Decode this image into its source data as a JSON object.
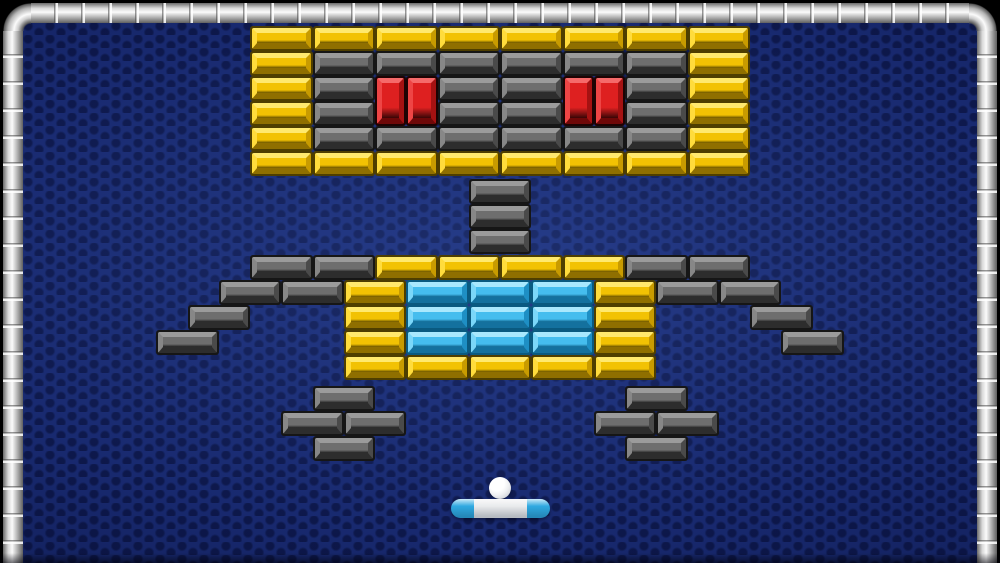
{
  "field": {
    "background_base": "#18296F",
    "texture_dot": "#040A2D",
    "frame_silver_bright": "#FBFBFB",
    "frame_silver_mid": "#C6C6C6",
    "frame_silver_edge": "#5E5E5E"
  },
  "colors": {
    "bricks": {
      "yellow": {
        "outline": "#4E3E00",
        "light": "#FFE96E",
        "light_mid": "#FFDC3C",
        "face": "#F2C203",
        "shadow_mid": "#C89B00",
        "shadow": "#8F6F00"
      },
      "gray": {
        "outline": "#161616",
        "light": "#9B9B9B",
        "light_mid": "#878787",
        "face": "#6E6E6E",
        "shadow_mid": "#4A4A4A",
        "shadow": "#2D2D2D"
      },
      "red": {
        "outline": "#1E0303",
        "light": "#F56A6A",
        "light_mid": "#EE4545",
        "face": "#DE2020",
        "shadow_mid": "#A51212",
        "shadow": "#6E0808"
      },
      "cyan": {
        "outline": "#0A5A80",
        "light": "#A9E8FD",
        "light_mid": "#7BD7F9",
        "face": "#45BDEE",
        "shadow_mid": "#1E8FC4",
        "shadow": "#14719E"
      }
    },
    "ball": "#FFFFFF",
    "paddle_end": "#2FA9E1",
    "paddle_center": "#E9EAEC"
  },
  "bricks": {
    "default_w": 62.5,
    "default_h": 25,
    "list": [
      {
        "x": 250,
        "y": 26,
        "c": "yellow"
      },
      {
        "x": 312.5,
        "y": 26,
        "c": "yellow"
      },
      {
        "x": 375,
        "y": 26,
        "c": "yellow"
      },
      {
        "x": 437.5,
        "y": 26,
        "c": "yellow"
      },
      {
        "x": 500,
        "y": 26,
        "c": "yellow"
      },
      {
        "x": 562.5,
        "y": 26,
        "c": "yellow"
      },
      {
        "x": 625,
        "y": 26,
        "c": "yellow"
      },
      {
        "x": 687.5,
        "y": 26,
        "c": "yellow"
      },
      {
        "x": 250,
        "y": 51,
        "c": "yellow"
      },
      {
        "x": 312.5,
        "y": 51,
        "c": "gray"
      },
      {
        "x": 375,
        "y": 51,
        "c": "gray"
      },
      {
        "x": 437.5,
        "y": 51,
        "c": "gray"
      },
      {
        "x": 500,
        "y": 51,
        "c": "gray"
      },
      {
        "x": 562.5,
        "y": 51,
        "c": "gray"
      },
      {
        "x": 625,
        "y": 51,
        "c": "gray"
      },
      {
        "x": 687.5,
        "y": 51,
        "c": "yellow"
      },
      {
        "x": 250,
        "y": 76,
        "c": "yellow"
      },
      {
        "x": 312.5,
        "y": 76,
        "c": "gray"
      },
      {
        "x": 437.5,
        "y": 76,
        "c": "gray"
      },
      {
        "x": 500,
        "y": 76,
        "c": "gray"
      },
      {
        "x": 625,
        "y": 76,
        "c": "gray"
      },
      {
        "x": 687.5,
        "y": 76,
        "c": "yellow"
      },
      {
        "x": 375,
        "y": 76,
        "w": 31.25,
        "h": 50,
        "c": "red"
      },
      {
        "x": 406.25,
        "y": 76,
        "w": 31.25,
        "h": 50,
        "c": "red"
      },
      {
        "x": 562.5,
        "y": 76,
        "w": 31.25,
        "h": 50,
        "c": "red"
      },
      {
        "x": 593.75,
        "y": 76,
        "w": 31.25,
        "h": 50,
        "c": "red"
      },
      {
        "x": 250,
        "y": 101,
        "c": "yellow"
      },
      {
        "x": 312.5,
        "y": 101,
        "c": "gray"
      },
      {
        "x": 437.5,
        "y": 101,
        "c": "gray"
      },
      {
        "x": 500,
        "y": 101,
        "c": "gray"
      },
      {
        "x": 625,
        "y": 101,
        "c": "gray"
      },
      {
        "x": 687.5,
        "y": 101,
        "c": "yellow"
      },
      {
        "x": 250,
        "y": 126,
        "c": "yellow"
      },
      {
        "x": 312.5,
        "y": 126,
        "c": "gray"
      },
      {
        "x": 375,
        "y": 126,
        "c": "gray"
      },
      {
        "x": 437.5,
        "y": 126,
        "c": "gray"
      },
      {
        "x": 500,
        "y": 126,
        "c": "gray"
      },
      {
        "x": 562.5,
        "y": 126,
        "c": "gray"
      },
      {
        "x": 625,
        "y": 126,
        "c": "gray"
      },
      {
        "x": 687.5,
        "y": 126,
        "c": "yellow"
      },
      {
        "x": 250,
        "y": 151,
        "c": "yellow"
      },
      {
        "x": 312.5,
        "y": 151,
        "c": "yellow"
      },
      {
        "x": 375,
        "y": 151,
        "c": "yellow"
      },
      {
        "x": 437.5,
        "y": 151,
        "c": "yellow"
      },
      {
        "x": 500,
        "y": 151,
        "c": "yellow"
      },
      {
        "x": 562.5,
        "y": 151,
        "c": "yellow"
      },
      {
        "x": 625,
        "y": 151,
        "c": "yellow"
      },
      {
        "x": 687.5,
        "y": 151,
        "c": "yellow"
      },
      {
        "x": 468.75,
        "y": 179,
        "c": "gray"
      },
      {
        "x": 468.75,
        "y": 204,
        "c": "gray"
      },
      {
        "x": 468.75,
        "y": 229,
        "c": "gray"
      },
      {
        "x": 250,
        "y": 255,
        "c": "gray"
      },
      {
        "x": 312.5,
        "y": 255,
        "c": "gray"
      },
      {
        "x": 375,
        "y": 255,
        "c": "yellow"
      },
      {
        "x": 437.5,
        "y": 255,
        "c": "yellow"
      },
      {
        "x": 500,
        "y": 255,
        "c": "yellow"
      },
      {
        "x": 562.5,
        "y": 255,
        "c": "yellow"
      },
      {
        "x": 625,
        "y": 255,
        "c": "gray"
      },
      {
        "x": 687.5,
        "y": 255,
        "c": "gray"
      },
      {
        "x": 218.75,
        "y": 280,
        "c": "gray"
      },
      {
        "x": 281.25,
        "y": 280,
        "c": "gray"
      },
      {
        "x": 343.75,
        "y": 280,
        "c": "yellow"
      },
      {
        "x": 406.25,
        "y": 280,
        "c": "cyan"
      },
      {
        "x": 468.75,
        "y": 280,
        "c": "cyan"
      },
      {
        "x": 531.25,
        "y": 280,
        "c": "cyan"
      },
      {
        "x": 593.75,
        "y": 280,
        "c": "yellow"
      },
      {
        "x": 656.25,
        "y": 280,
        "c": "gray"
      },
      {
        "x": 718.75,
        "y": 280,
        "c": "gray"
      },
      {
        "x": 187.5,
        "y": 305,
        "c": "gray"
      },
      {
        "x": 343.75,
        "y": 305,
        "c": "yellow"
      },
      {
        "x": 406.25,
        "y": 305,
        "c": "cyan"
      },
      {
        "x": 468.75,
        "y": 305,
        "c": "cyan"
      },
      {
        "x": 531.25,
        "y": 305,
        "c": "cyan"
      },
      {
        "x": 593.75,
        "y": 305,
        "c": "yellow"
      },
      {
        "x": 750,
        "y": 305,
        "c": "gray"
      },
      {
        "x": 156.25,
        "y": 330,
        "c": "gray"
      },
      {
        "x": 343.75,
        "y": 330,
        "c": "yellow"
      },
      {
        "x": 406.25,
        "y": 330,
        "c": "cyan"
      },
      {
        "x": 468.75,
        "y": 330,
        "c": "cyan"
      },
      {
        "x": 531.25,
        "y": 330,
        "c": "cyan"
      },
      {
        "x": 593.75,
        "y": 330,
        "c": "yellow"
      },
      {
        "x": 781.25,
        "y": 330,
        "c": "gray"
      },
      {
        "x": 343.75,
        "y": 355,
        "c": "yellow"
      },
      {
        "x": 406.25,
        "y": 355,
        "c": "yellow"
      },
      {
        "x": 468.75,
        "y": 355,
        "c": "yellow"
      },
      {
        "x": 531.25,
        "y": 355,
        "c": "yellow"
      },
      {
        "x": 593.75,
        "y": 355,
        "c": "yellow"
      },
      {
        "x": 312.5,
        "y": 386,
        "c": "gray"
      },
      {
        "x": 625,
        "y": 386,
        "c": "gray"
      },
      {
        "x": 281.25,
        "y": 411,
        "c": "gray"
      },
      {
        "x": 343.75,
        "y": 411,
        "c": "gray"
      },
      {
        "x": 593.75,
        "y": 411,
        "c": "gray"
      },
      {
        "x": 656.25,
        "y": 411,
        "c": "gray"
      },
      {
        "x": 312.5,
        "y": 436,
        "c": "gray"
      },
      {
        "x": 625,
        "y": 436,
        "c": "gray"
      }
    ]
  },
  "ball": {
    "x": 489,
    "y": 477,
    "d": 22
  },
  "paddle": {
    "x": 451,
    "y": 499,
    "w": 99,
    "h": 19,
    "cap_w": 23
  }
}
